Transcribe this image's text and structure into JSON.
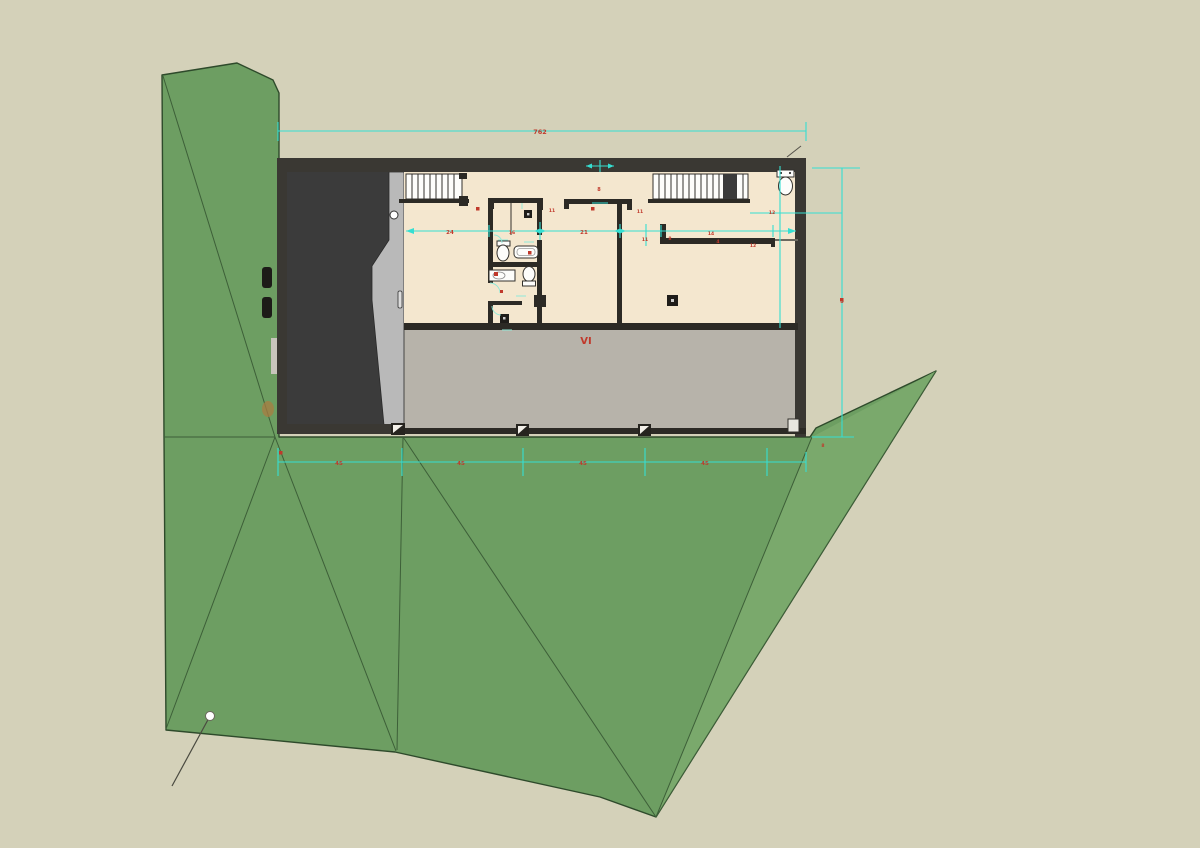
{
  "scene": {
    "type": "architectural site plan, top view with terrain",
    "palette": {
      "background": "#d4d1b9",
      "terrain_green": "#6d9e62",
      "terrain_green_light": "#7aa96c",
      "terrain_edge": "#2e4a2b",
      "dimension_cyan": "#35dfd2",
      "annotation_red": "#c0392b",
      "floor_cream": "#f4e7cf",
      "slab_gray": "#b7b3aa",
      "garage_dark": "#3b3b3b",
      "wedge_gray": "#b9b9b9"
    }
  },
  "labels": {
    "dim_top": "762",
    "dim_right": "9",
    "dim_bottom_1": "45",
    "dim_bottom_2": "45",
    "dim_bottom_3": "45",
    "dim_bottom_4": "45",
    "dim_bottom_right": "8",
    "dim_opening": "8",
    "dim_11_left": "11",
    "dim_11_mid": "11",
    "row_24": "24",
    "row_16": "16",
    "row_21": "21",
    "row_11": "11",
    "row_14": "14",
    "row_4": "4",
    "row_12": "12",
    "col_12": "12",
    "col_8": "8",
    "room_label": "VI"
  }
}
